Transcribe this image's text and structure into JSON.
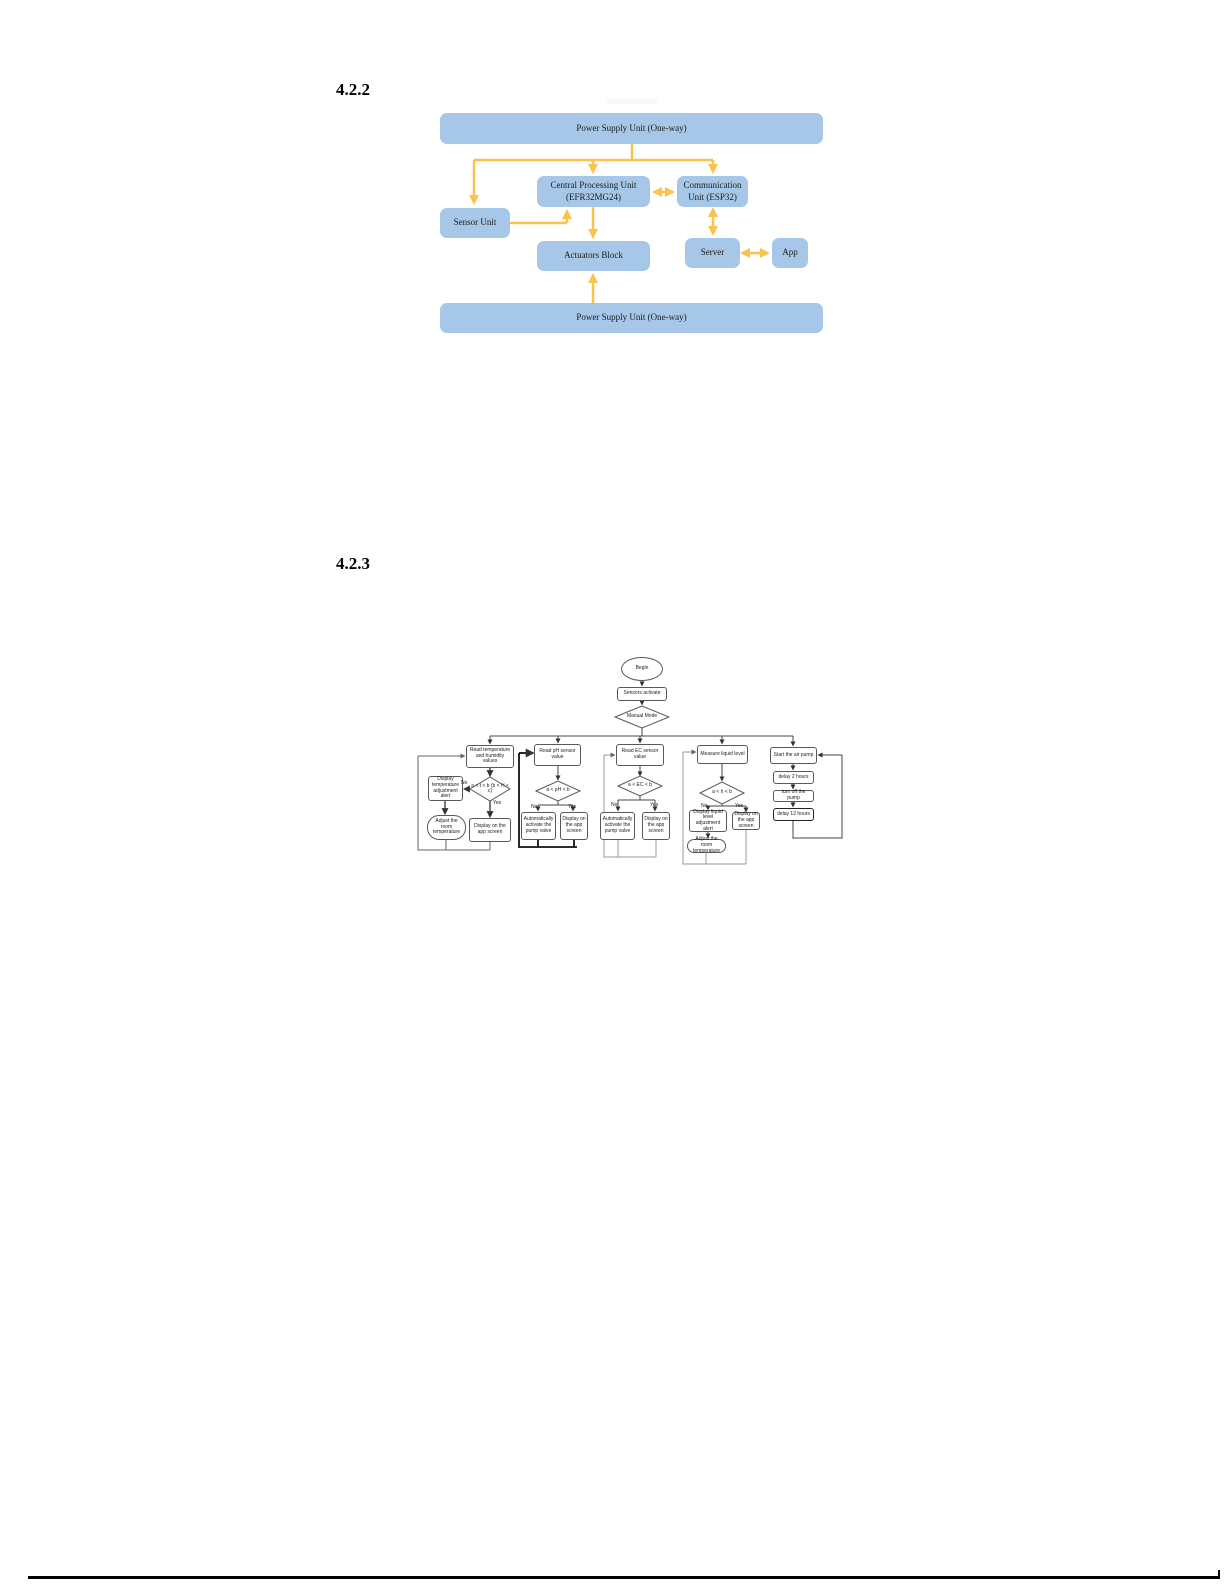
{
  "headings": {
    "section_1": "4.2.2",
    "section_2": "4.2.3"
  },
  "block_diagram": {
    "colors": {
      "box_fill": "#A7C7E8",
      "arrow": "#FBC34D",
      "text": "#1B1B1B"
    },
    "nodes": {
      "psu_top": "Power Supply Unit (One-way)",
      "cpu": "Central Processing Unit (EFR32MG24)",
      "comm": "Communication Unit (ESP32)",
      "sensor": "Sensor Unit",
      "actuators": "Actuators Block",
      "server": "Server",
      "app": "App",
      "psu_bottom": "Power Supply Unit (One-way)"
    }
  },
  "flowchart": {
    "start": "Begin",
    "sensors_activate": "Sensors activate",
    "manual_mode": "Manual Mode",
    "yes": "Yes",
    "no": "No",
    "branches": {
      "temperature": {
        "read": "Read temperature and humidity values",
        "condition": "a < t < b (b < H < c)",
        "alert": "Display temperature adjustment alert",
        "adjust": "Adjust the room temperature",
        "display": "Display on the app screen"
      },
      "ph": {
        "read": "Read pH sensor value",
        "condition": "a < pH < b",
        "no_action": "Automatically activate the pump valve",
        "display": "Display on the app screen"
      },
      "ec": {
        "read": "Read EC sensor value",
        "condition": "a < EC < b",
        "no_action": "Automatically activate the pump valve",
        "display": "Display on the app screen"
      },
      "liquid": {
        "read": "Measure liquid level",
        "condition": "a < h < b",
        "alert": "Display liquid level adjustment alert",
        "adjust": "Adjust the room temperature",
        "display": "Display on the app screen"
      },
      "air_pump": {
        "start": "Start the air pump",
        "delay1": "delay 2 hours",
        "turn_off": "turn off the pump",
        "delay2": "delay 12 hours"
      }
    }
  }
}
